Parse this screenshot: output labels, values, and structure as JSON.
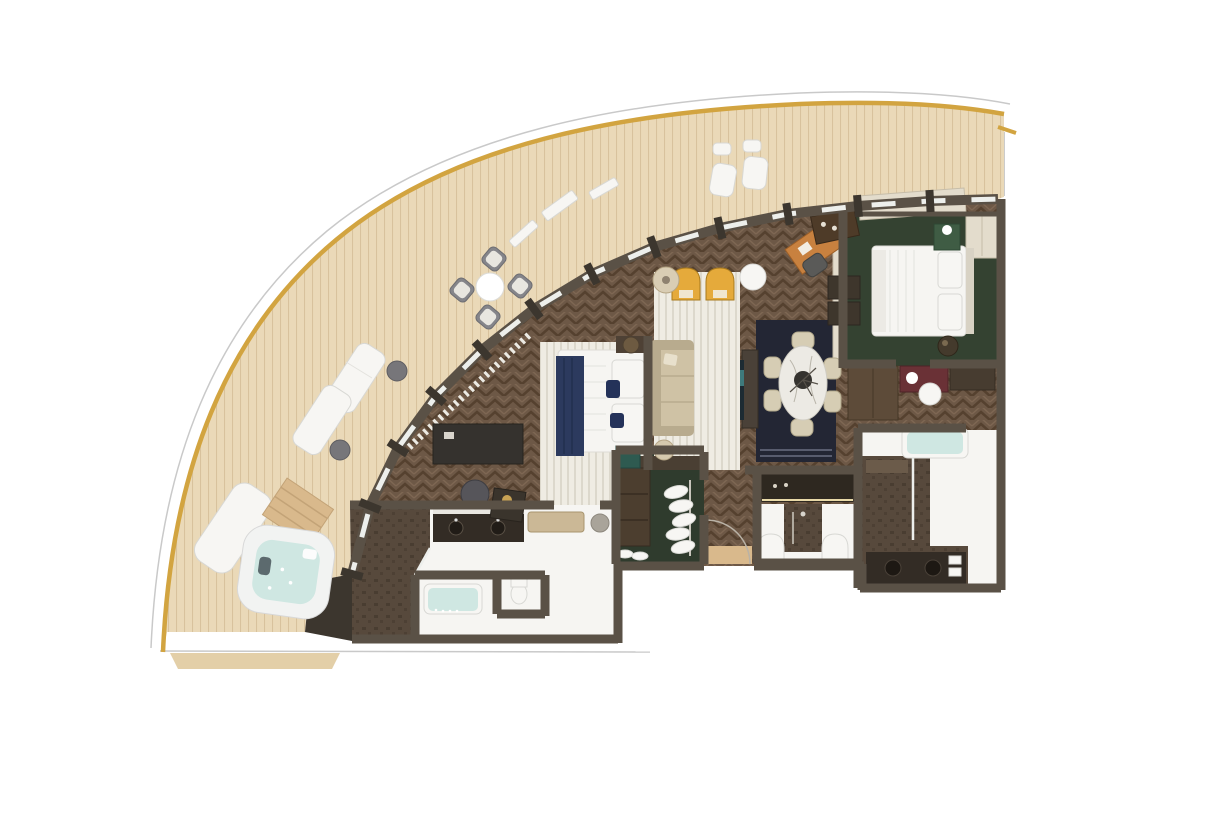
{
  "scene": {
    "type": "floor-plan",
    "subject": "aerial-3d-floor-plan-curved-suite-with-wraparound-balcony-and-whirlpool"
  },
  "colors": {
    "page_bg": "#ffffff",
    "deck": "#ead9b8",
    "deck_plank": "#d8c29d",
    "deck_apron": "#e3cfa8",
    "gold_rail": "#d2a440",
    "hull_line": "#c9c9c9",
    "wood_floor": "#6d5846",
    "wood_floor_dark": "#55412f",
    "wood_floor_light": "#7e6753",
    "wall": "#5a5146",
    "wall_dark": "#3c362e",
    "glass": "#edefec",
    "rug_white": "#efece3",
    "rug_stripe": "#d8d3c6",
    "rug_navy": "#232634",
    "green_floor": "#344231",
    "closet_green": "#2f3b2d",
    "stone": "#57493c",
    "stone_dark": "#463a2e",
    "bath_white": "#f6f5f2",
    "water_aqua": "#cfe7e2",
    "sofa_beige": "#cfc2a5",
    "chair_yellow": "#e5aa3b",
    "bed_white": "#f6f5f2",
    "navy_throw": "#2c3a5e",
    "navy_pillow": "#243259",
    "marble": "#eceae4",
    "desk_orange": "#c8813f",
    "maroon": "#6a3136",
    "teal_cube": "#2e5a50",
    "tan_wood": "#d9b98c",
    "cream_cabinet": "#e3dccc",
    "console_dark": "#2e2820",
    "vanity_dark": "#332c25"
  },
  "rooms": [
    {
      "name": "balcony",
      "furniture": [
        "round-dining-table",
        "dining-chair",
        "dining-chair",
        "dining-chair",
        "dining-chair",
        "sun-lounger",
        "sun-lounger",
        "side-table",
        "side-table",
        "lounge-chair",
        "lounge-chair",
        "ottoman",
        "ottoman",
        "whirlpool-tub",
        "whirlpool-steps",
        "daybed"
      ]
    },
    {
      "name": "living-room",
      "furniture": [
        "armchair-yellow",
        "armchair-yellow",
        "floor-lamp",
        "side-table-round",
        "sofa",
        "tv-console",
        "writing-desk",
        "desk-chair",
        "wall-cabinet",
        "wall-cabinet",
        "table-lamp"
      ]
    },
    {
      "name": "dining-area",
      "furniture": [
        "oval-marble-table",
        "centerpiece",
        "dining-chair",
        "dining-chair",
        "dining-chair",
        "dining-chair",
        "dining-chair",
        "dining-chair",
        "navy-area-rug",
        "bar-cabinet"
      ]
    },
    {
      "name": "master-bedroom",
      "furniture": [
        "double-bed",
        "navy-throw",
        "pillows",
        "nightstand",
        "sphere-lamp",
        "bench",
        "pouf",
        "media-console",
        "desk",
        "desk-chair",
        "wardrobe-column",
        "teal-side-table",
        "striped-area-rug",
        "curtains"
      ]
    },
    {
      "name": "master-bathroom",
      "furniture": [
        "bathtub",
        "double-vanity",
        "mirror",
        "toilet",
        "walk-in-shower"
      ]
    },
    {
      "name": "walk-in-closet",
      "furniture": [
        "clothes-rail",
        "hanging-clothes",
        "shelf"
      ]
    },
    {
      "name": "entry-hall",
      "furniture": [
        "entry-door",
        "door-mat"
      ]
    },
    {
      "name": "guest-bathroom",
      "furniture": [
        "lit-console",
        "shower-column",
        "arched-door",
        "arched-door"
      ]
    },
    {
      "name": "bedroom-2",
      "furniture": [
        "double-bed",
        "pillows",
        "headboard",
        "wardrobe",
        "plant-table",
        "nightstand-lamp",
        "shelf-column",
        "window-cabinets"
      ]
    },
    {
      "name": "vanity-corridor",
      "furniture": [
        "dressing-table",
        "stool",
        "flowers",
        "cabinet"
      ]
    },
    {
      "name": "second-bathroom",
      "furniture": [
        "bathtub",
        "walk-in-shower",
        "shower-bench",
        "double-vanity"
      ]
    }
  ]
}
